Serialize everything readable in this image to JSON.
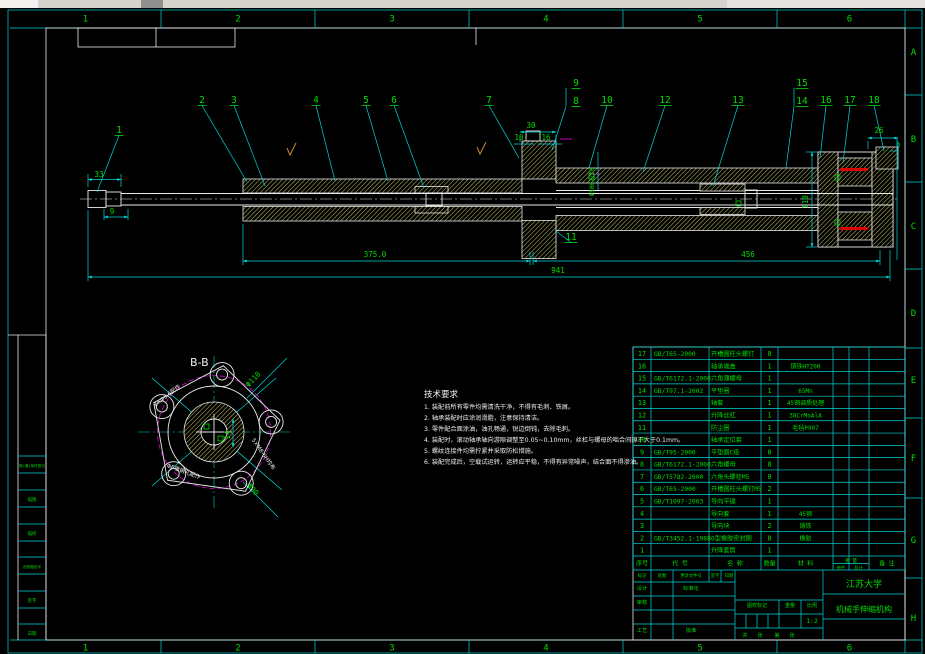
{
  "colors": {
    "background": "#000000",
    "outline_white": "#eaeaea",
    "dimension_cyan": "#00d8d8",
    "text_green": "#00dc00",
    "hatch_yellow": "#c9c96a",
    "seal_red": "#dc0000",
    "phantom_magenta": "#dd00dd",
    "window_strip_gray": "#d6d2cc"
  },
  "rulers": {
    "top": [
      "1",
      "2",
      "3",
      "4",
      "5",
      "6"
    ],
    "bottom": [
      "1",
      "2",
      "3",
      "4",
      "5",
      "6"
    ],
    "right": [
      "A",
      "B",
      "C",
      "D",
      "E",
      "F",
      "G",
      "H"
    ]
  },
  "balloons": [
    "1",
    "2",
    "3",
    "4",
    "5",
    "6",
    "7",
    "8",
    "9",
    "10",
    "11",
    "12",
    "13",
    "14",
    "15",
    "16",
    "17",
    "18"
  ],
  "dimensions": {
    "left_overhang": "33",
    "left_step": "9",
    "body_length": "375.0",
    "tube_length": "456",
    "overall_length": "941",
    "flange_width": "30",
    "flange_step1": "10",
    "flange_step2": "16",
    "cap_width": "26",
    "cap_lip": "7",
    "cap_height": "110",
    "bore_fit": "Φ50H7/f6",
    "section_key_width": "14",
    "section_bolt_circle": "Φ110",
    "section_boss": "Φ90"
  },
  "section_view": {
    "label": "B-B",
    "annotations": [
      "8×Φ6.6配作",
      "5×M8-6H均布",
      "Φ6锥销孔配作"
    ]
  },
  "notes": {
    "title": "技术要求",
    "lines": [
      "1. 装配前所有零件均需清洗干净，不得有毛刺、铁屑。",
      "2. 轴承装配时应涂润滑脂，注意保持清洁。",
      "3. 零件配合面涂油，油孔畅通，锐边倒钝，去除毛刺。",
      "4. 装配时，滚动轴承轴向游隙调整至0.05~0.10mm，丝杠与螺母的啮合间隙不大于0.1mm。",
      "5. 螺纹连接件均需拧紧并采取防松措施。",
      "6. 装配完成后，空载试运转，运转应平稳，不得有异常噪声，结合面不得渗油。"
    ]
  },
  "parts_list": {
    "headers": [
      "序号",
      "代 号",
      "名 称",
      "数量",
      "材 料",
      "备 注"
    ],
    "weight_label": "重 量",
    "weight_sub": [
      "单件",
      "总计"
    ],
    "rows": [
      {
        "no": "17",
        "code": "GB/T65-2000",
        "name": "开槽圆柱头螺钉",
        "qty": "8",
        "material": ""
      },
      {
        "no": "16",
        "code": "",
        "name": "轴承端盖",
        "qty": "1",
        "material": "铸铁HT200"
      },
      {
        "no": "15",
        "code": "GB/T6172.1-2000",
        "name": "六角薄螺母",
        "qty": "1",
        "material": ""
      },
      {
        "no": "14",
        "code": "GB/T97.1-2002",
        "name": "平垫圈",
        "qty": "1",
        "material": "65Mn"
      },
      {
        "no": "13",
        "code": "",
        "name": "轴套",
        "qty": "1",
        "material": "45钢调质处理"
      },
      {
        "no": "12",
        "code": "",
        "name": "升降丝杠",
        "qty": "1",
        "material": "38CrMoAlA"
      },
      {
        "no": "11",
        "code": "",
        "name": "防尘圈",
        "qty": "1",
        "material": "毛毡P907"
      },
      {
        "no": "10",
        "code": "",
        "name": "轴承定位套",
        "qty": "1",
        "material": ""
      },
      {
        "no": "9",
        "code": "GB/T95-2000",
        "name": "平垫圈C级",
        "qty": "8",
        "material": ""
      },
      {
        "no": "8",
        "code": "GB/T6172.1-2000",
        "name": "六角螺母",
        "qty": "8",
        "material": ""
      },
      {
        "no": "7",
        "code": "GB/T5782-2000",
        "name": "六角头螺栓M5",
        "qty": "8",
        "material": ""
      },
      {
        "no": "6",
        "code": "GB/T65-2000",
        "name": "开槽圆柱头螺钉M5",
        "qty": "2",
        "material": ""
      },
      {
        "no": "5",
        "code": "GB/T1097-2003",
        "name": "导向平键",
        "qty": "1",
        "material": ""
      },
      {
        "no": "4",
        "code": "",
        "name": "导向套",
        "qty": "1",
        "material": "45钢"
      },
      {
        "no": "3",
        "code": "",
        "name": "导向块",
        "qty": "2",
        "material": "铸铁"
      },
      {
        "no": "2",
        "code": "GB/T3452.1-1988",
        "name": "O型橡胶密封圈",
        "qty": "8",
        "material": "橡胶"
      },
      {
        "no": "1",
        "code": "",
        "name": "升降套筒",
        "qty": "1",
        "material": ""
      }
    ]
  },
  "title_block": {
    "university": "江苏大学",
    "drawing_title": "机械手伸缩机构",
    "revision_headers": [
      "标记",
      "处数",
      "更改文件号",
      "签字",
      "日期"
    ],
    "left_cells": [
      "设计",
      "标准化",
      "审核",
      "工艺",
      "批准"
    ],
    "stamp_headers": [
      "图样标记",
      "重量",
      "比例"
    ],
    "scale": "1:2",
    "sheet_labels": [
      "共",
      "张",
      "第",
      "张"
    ]
  },
  "binding_strip": {
    "labels": [
      "借(通)用件登记",
      "描图",
      "描校",
      "旧底图总号",
      "签字",
      "日期"
    ]
  }
}
